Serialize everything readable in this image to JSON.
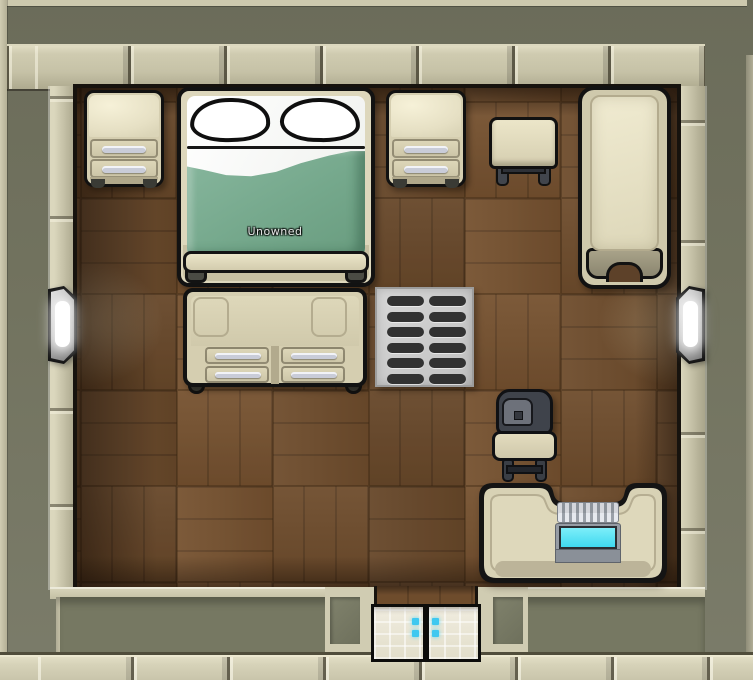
{
  "scene": {
    "name": "top-down bedroom",
    "bed": {
      "ownership_label": "Unowned"
    },
    "objects": [
      {
        "name": "end-table",
        "position": "north-west"
      },
      {
        "name": "double-bed",
        "position": "north",
        "label": "Unowned"
      },
      {
        "name": "end-table",
        "position": "north-center"
      },
      {
        "name": "stool",
        "position": "north"
      },
      {
        "name": "armchair",
        "position": "north-east"
      },
      {
        "name": "dresser",
        "position": "center-west"
      },
      {
        "name": "vent",
        "position": "center"
      },
      {
        "name": "wall-lamp",
        "position": "west-wall"
      },
      {
        "name": "wall-lamp",
        "position": "east-wall"
      },
      {
        "name": "dining-chair",
        "position": "south-east"
      },
      {
        "name": "computer-desk",
        "position": "south-east"
      },
      {
        "name": "autodoor",
        "position": "south-wall"
      }
    ],
    "colors": {
      "outside_ground": "#73745f",
      "wall_face": "#cdc9ae",
      "floor_wood": "#6e4c2c",
      "blanket_green": "#79ac90",
      "furniture_beige": "#d7d0b2",
      "screen_cyan": "#55e2f6",
      "door_indicator_cyan": "#3fc8f0",
      "lamp_glow": "#ffffff"
    }
  }
}
